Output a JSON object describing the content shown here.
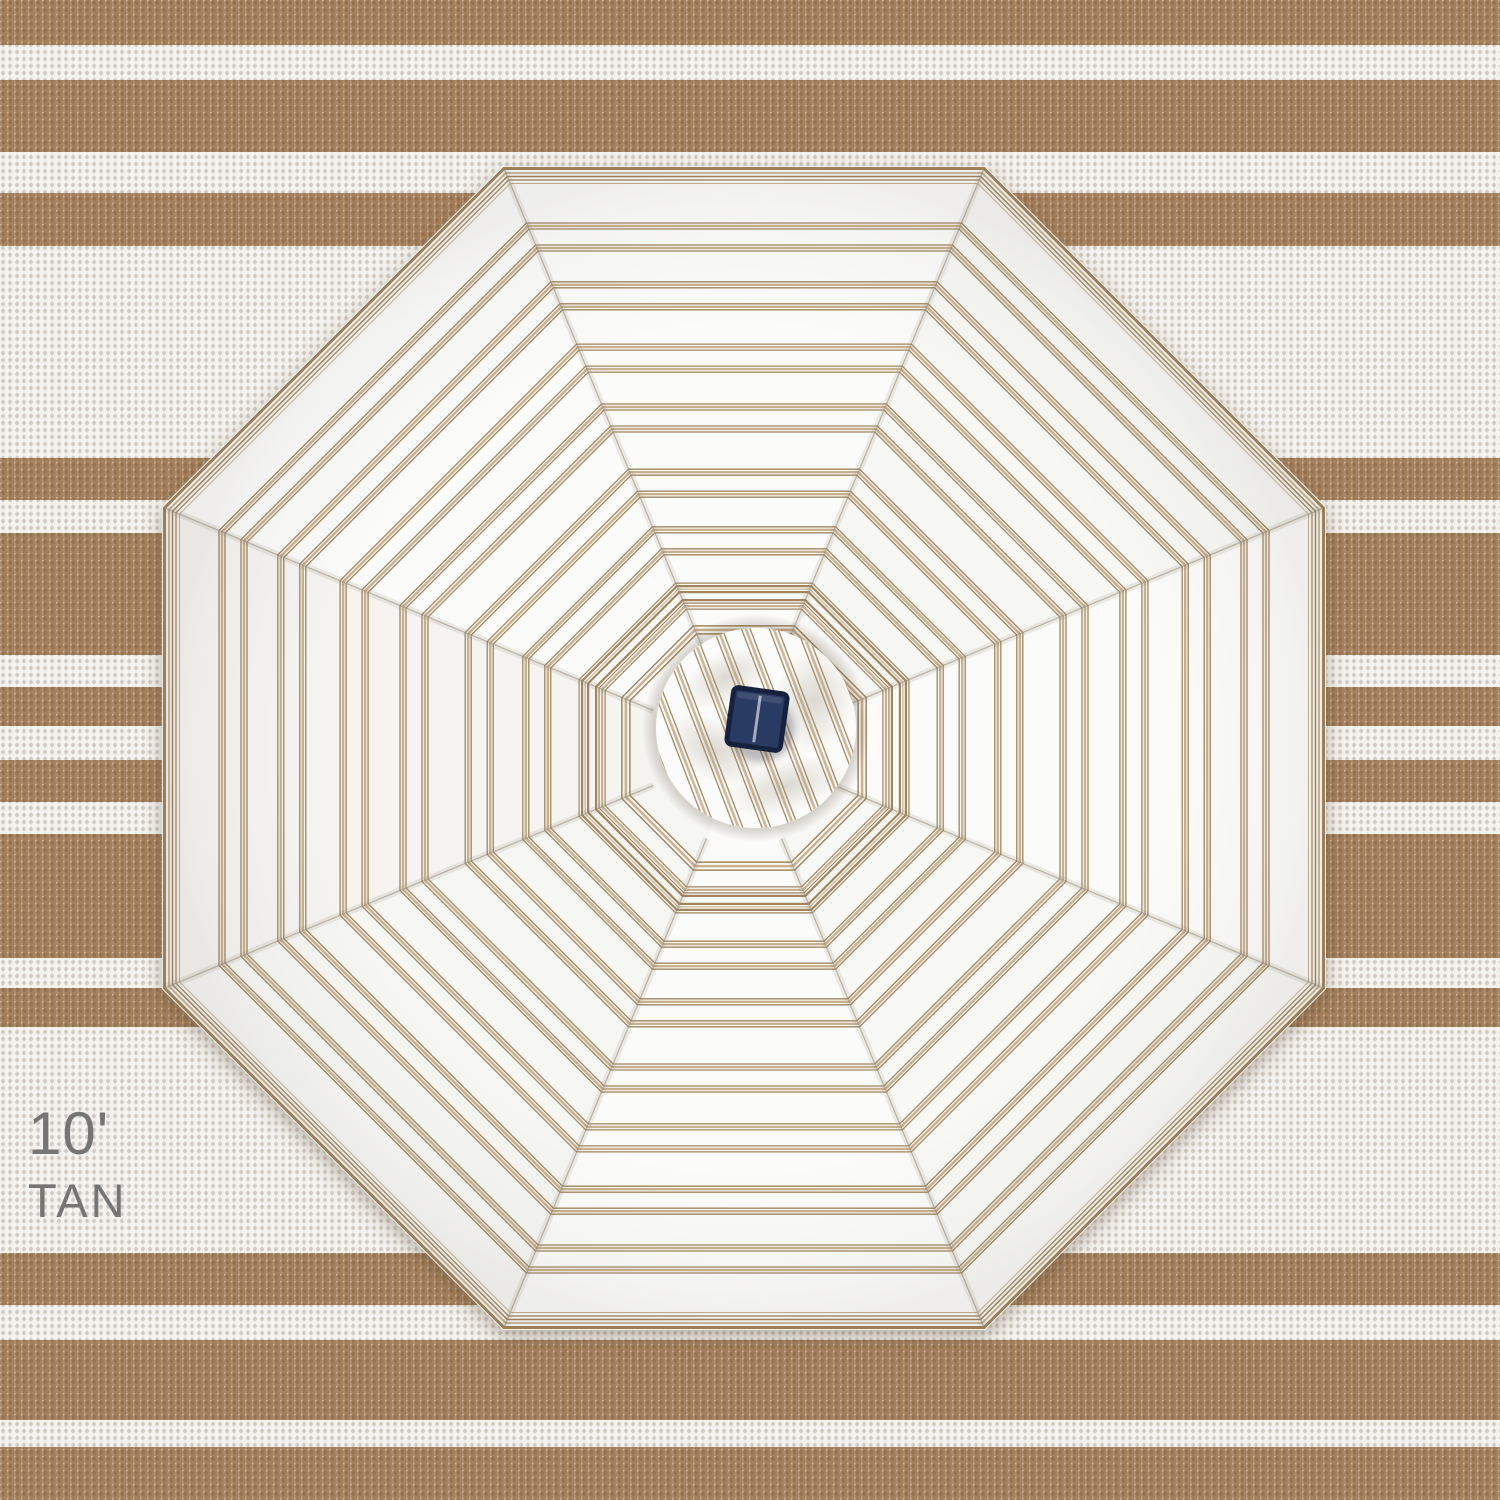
{
  "label": {
    "size": "10'",
    "color_name": "TAN"
  },
  "colors": {
    "rug_tan": "#a5815c",
    "rug_white": "#f4f2ee",
    "canopy_white": "#fbfbf9",
    "stripe_dark_tan": "#a1855e",
    "stripe_light_tan": "#c7b190",
    "seam_gray": "#b5a892",
    "label_gray": "#757574",
    "solar_panel_navy": "#2c3b63",
    "solar_panel_border": "#16203c",
    "solar_panel_line": "#b3bac8",
    "shadow": "#5b4630"
  },
  "rug": {
    "height": 1500,
    "tan_bands": [
      [
        0,
        45
      ],
      [
        80,
        152
      ],
      [
        193,
        246
      ],
      [
        458,
        500
      ],
      [
        533,
        655
      ],
      [
        687,
        726
      ],
      [
        760,
        802
      ],
      [
        834,
        958
      ],
      [
        988,
        1027
      ],
      [
        1253,
        1305
      ],
      [
        1340,
        1420
      ],
      [
        1447,
        1500
      ]
    ]
  },
  "umbrella": {
    "center_x": 744,
    "center_y": 748,
    "apothem": 582,
    "sides": 8,
    "rotation_deg": 0,
    "rim_lines": [
      [
        2.5,
        3.0,
        "d"
      ],
      [
        7.0,
        1.8,
        "l"
      ],
      [
        10.5,
        1.5,
        "d"
      ],
      [
        14.0,
        1.2,
        "d"
      ],
      [
        17.5,
        1.0,
        "l"
      ]
    ],
    "ring_fractions": [
      0.878,
      0.777,
      0.67,
      0.567,
      0.455,
      0.356
    ],
    "ring_cluster_lines": [
      [
        -14,
        1.3,
        "d"
      ],
      [
        -11,
        2.4,
        "l"
      ],
      [
        -8,
        1.3,
        "d"
      ],
      [
        8,
        1.3,
        "d"
      ],
      [
        11,
        2.4,
        "l"
      ],
      [
        14,
        1.3,
        "d"
      ]
    ],
    "inner_ring": {
      "fraction": 0.261,
      "lines": [
        [
          -13,
          1.2,
          "d"
        ],
        [
          -10,
          2.2,
          "l"
        ],
        [
          -7,
          1.2,
          "d"
        ],
        [
          -4,
          2.2,
          "d"
        ],
        [
          4,
          2.2,
          "d"
        ],
        [
          7,
          1.2,
          "l"
        ],
        [
          10,
          2.2,
          "d"
        ],
        [
          13,
          1.2,
          "d"
        ]
      ]
    },
    "inner_ring2": {
      "fraction": 0.203,
      "lines": [
        [
          -4,
          1.5,
          "d"
        ],
        [
          0,
          2.5,
          "l"
        ],
        [
          4,
          1.5,
          "d"
        ]
      ]
    },
    "cap": {
      "cx": 756,
      "cy": 728,
      "r": 100,
      "stripe_period": 26,
      "stripe_tilt_deg": -21,
      "stripe_lines": [
        [
          -4,
          1.4,
          "d"
        ],
        [
          0,
          2.6,
          "l"
        ],
        [
          4,
          1.4,
          "d"
        ]
      ]
    },
    "solar_panel": {
      "cx": 757,
      "cy": 719,
      "w": 54,
      "h": 57,
      "rotation_deg": 8
    }
  }
}
